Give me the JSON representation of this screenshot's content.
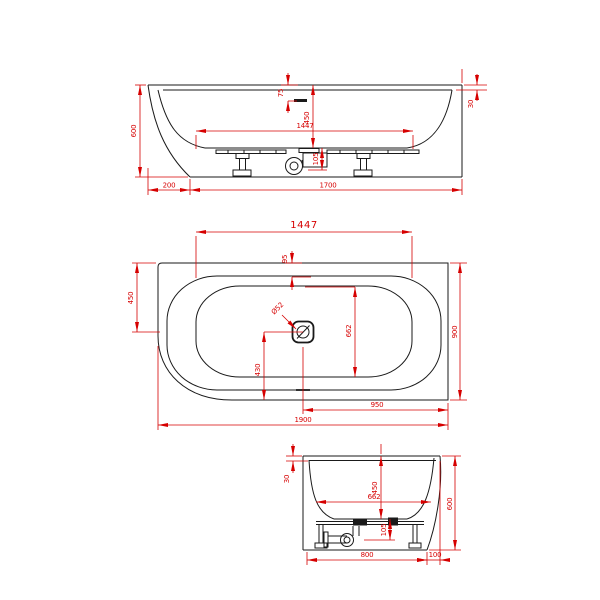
{
  "colors": {
    "dimension_red": "#d60000",
    "outline_black": "#1a1a1a",
    "background": "#ffffff"
  },
  "front_view": {
    "dims": {
      "height": "600",
      "rim_overhang": "200",
      "base_length": "1700",
      "inner_length": "1447",
      "depth": "450",
      "overflow_offset": "75",
      "drain_height": "105",
      "rim_step": "30"
    }
  },
  "plan_view": {
    "dims": {
      "inner_length": "1447",
      "center_offset": "450",
      "width": "900",
      "length": "1900",
      "drain_to_end": "950",
      "inner_width": "662",
      "drain_to_front": "430",
      "rim_width": "95",
      "drain_diameter": "Ø52"
    }
  },
  "end_view": {
    "dims": {
      "rim_step": "30",
      "depth": "450",
      "inner_width": "662",
      "height": "600",
      "drain_height": "105",
      "base_width": "800",
      "rim_overhang": "100"
    }
  }
}
